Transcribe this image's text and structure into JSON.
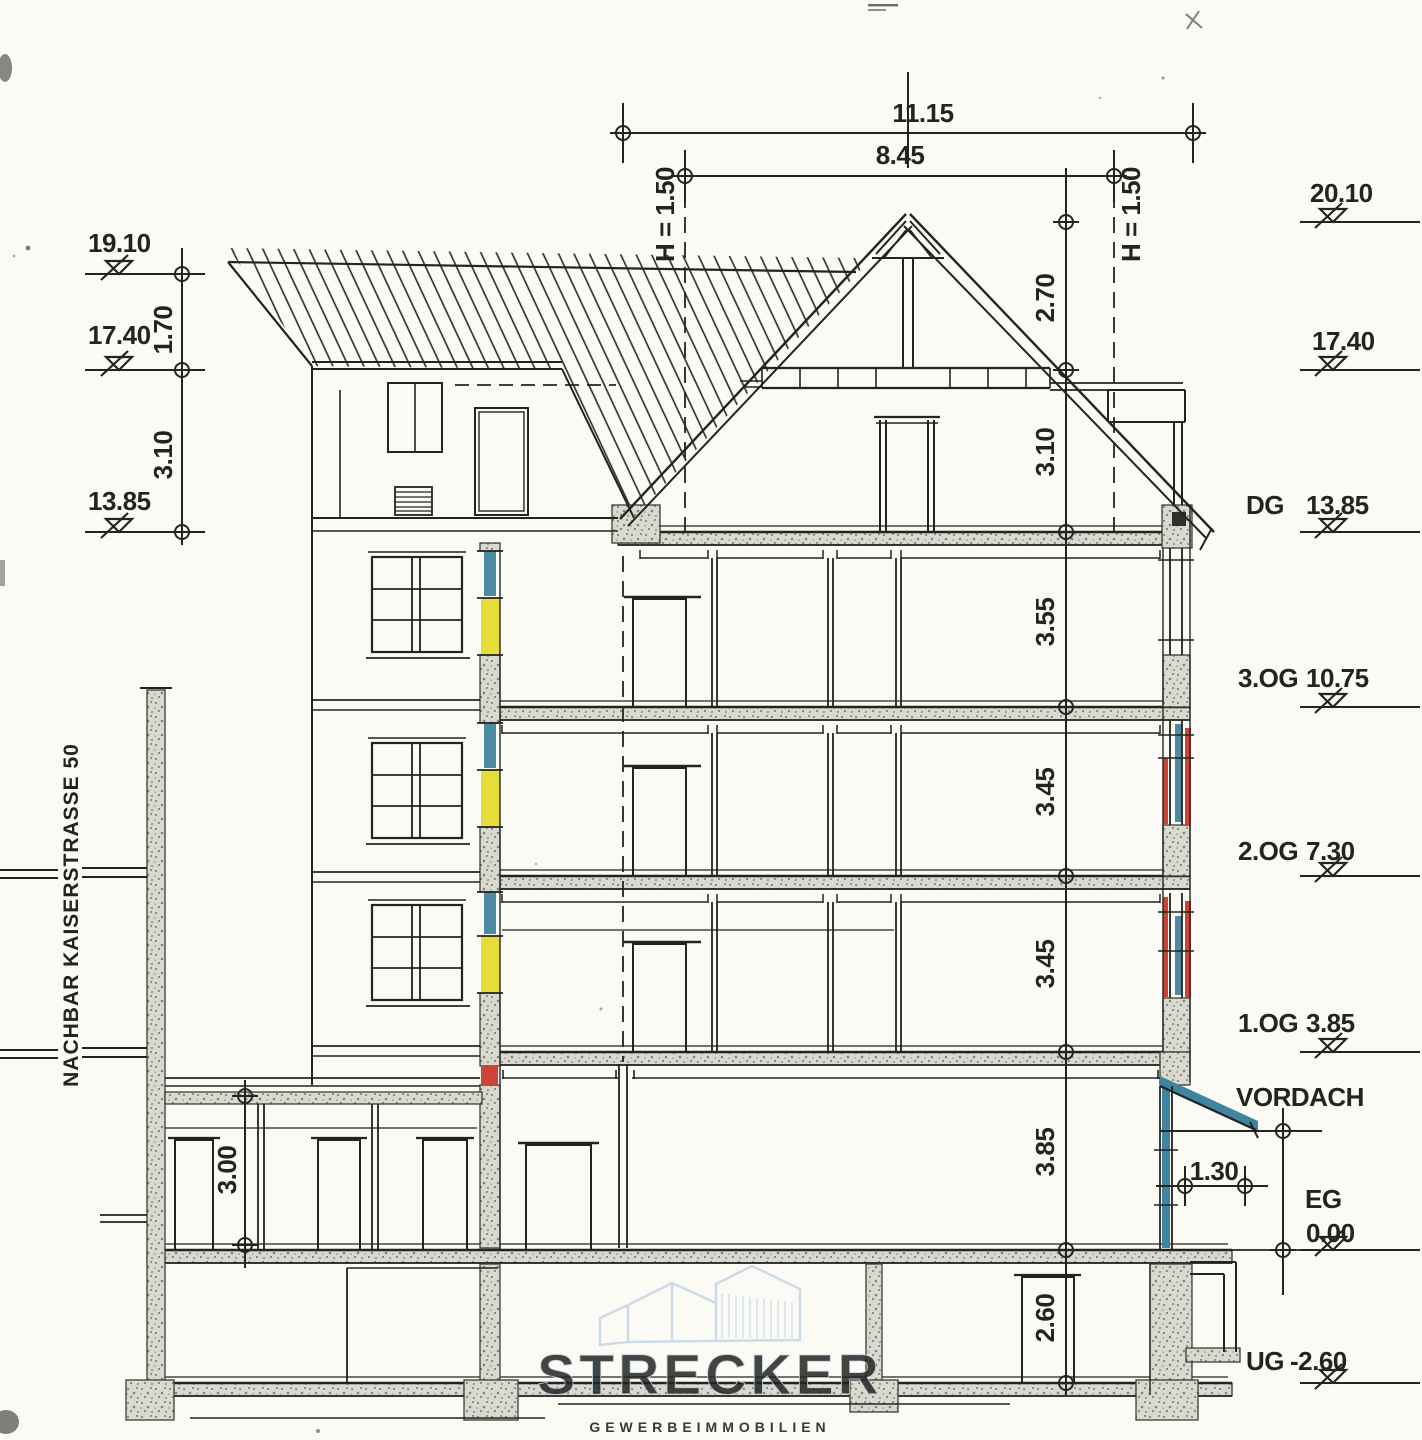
{
  "colors": {
    "ink": "#232320",
    "wall_gray": "#d9d9cf",
    "glass_blue": "#4d8ba3",
    "spandrel_yellow": "#e4dd3a",
    "accent_red": "#cc4433",
    "canopy_teal": "#3f85a0",
    "watermark_blue": "#c9dcef"
  },
  "annotations": {
    "neighbor_building": "NACHBAR KAISERSTRASSE 50",
    "canopy": "VORDACH"
  },
  "top_dimensions": {
    "overall_width": "11.15",
    "ridge_width": "8.45",
    "headroom_left": "H = 1.50",
    "headroom_right": "H = 1.50"
  },
  "left_levels": {
    "parapet": "19.10",
    "upper": "17.40",
    "attic": "13.85",
    "dim_upper": "1.70",
    "dim_lower": "3.10"
  },
  "right_levels": {
    "ridge": "20.10",
    "collar": "17.40",
    "dg_label": "DG",
    "dg": "13.85",
    "og3_label": "3.OG",
    "og3": "10.75",
    "og2_label": "2.OG",
    "og2": "7.30",
    "og1_label": "1.OG",
    "og1": "3.85",
    "eg_label": "EG",
    "eg": "0.00",
    "ug_label": "UG",
    "ug": "-2.60"
  },
  "storey_heights": {
    "roof_upper": "2.70",
    "roof_lower": "3.10",
    "og3": "3.55",
    "og2": "3.45",
    "og1": "3.45",
    "eg": "3.85",
    "ug": "2.60",
    "annex": "3.00",
    "canopy_offset": "1.30"
  },
  "watermark": {
    "brand": "STRECKER",
    "tagline": "GEWERBEIMMOBILIEN"
  }
}
